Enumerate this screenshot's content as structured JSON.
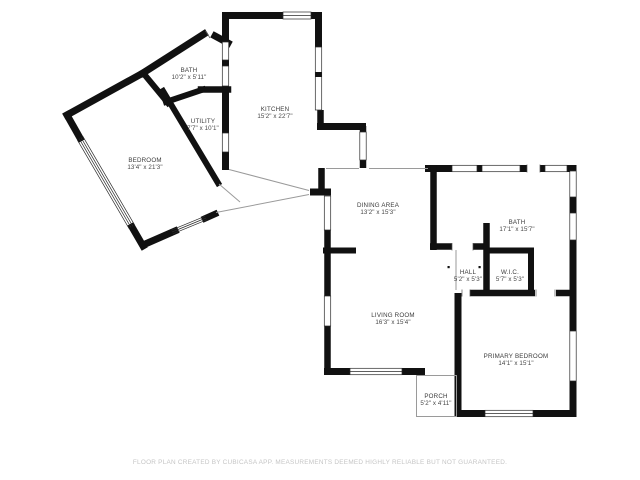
{
  "colors": {
    "background": "#ffffff",
    "walls": "#111111",
    "opening_lines": "#9a9a9a",
    "label_text": "#3b3b3b",
    "footer_text": "#c5c5c5"
  },
  "rooms": [
    {
      "name": "BATH",
      "dims": "10'2\" x 5'11\""
    },
    {
      "name": "UTILITY",
      "dims": "7'7\" x 10'1\""
    },
    {
      "name": "KITCHEN",
      "dims": "15'2\" x 22'7\""
    },
    {
      "name": "BEDROOM",
      "dims": "13'4\" x 21'3\""
    },
    {
      "name": "DINING AREA",
      "dims": "13'2\" x 15'3\""
    },
    {
      "name": "BATH",
      "dims": "17'1\" x 15'7\""
    },
    {
      "name": "HALL",
      "dims": "5'2\" x 5'3\""
    },
    {
      "name": "W.I.C.",
      "dims": "5'7\" x 5'3\""
    },
    {
      "name": "LIVING ROOM",
      "dims": "16'3\" x 15'4\""
    },
    {
      "name": "PRIMARY BEDROOM",
      "dims": "14'1\" x 15'1\""
    },
    {
      "name": "PORCH",
      "dims": "5'2\" x 4'11\""
    }
  ],
  "footer": {
    "disclaimer": "FLOOR PLAN CREATED BY CUBICASA APP. MEASUREMENTS DEEMED HIGHLY RELIABLE BUT NOT GUARANTEED."
  }
}
